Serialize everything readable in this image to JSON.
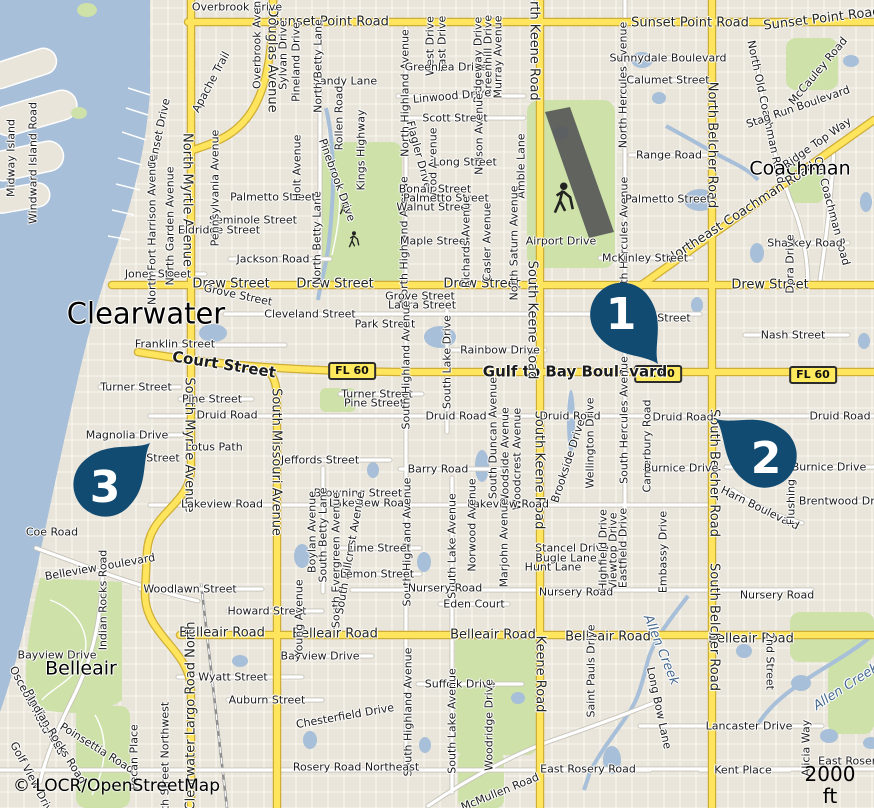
{
  "map": {
    "attribution": "© LOCR/OpenStreetMap",
    "scale_label": "2000 ft",
    "colors": {
      "marker": "#114b72",
      "marker_text": "#ffffff",
      "water": "#a7bfd8",
      "land": "#e9e5db",
      "park": "#cde1a9",
      "road_major": "#ffe55e",
      "road_major_casing": "#cfae35",
      "road_minor": "#ffffff",
      "badge_bg": "#ffe95c"
    },
    "markers": [
      {
        "n": "1",
        "tx": 658,
        "ty": 364,
        "rot": -36,
        "nx": 621,
        "ny": 313
      },
      {
        "n": "2",
        "tx": 716,
        "ty": 419,
        "rot": 127,
        "nx": 766,
        "ny": 457
      },
      {
        "n": "3",
        "tx": 150,
        "ty": 443,
        "rot": -133,
        "nx": 105,
        "ny": 486
      }
    ],
    "badges": [
      {
        "t": "FL 60",
        "x": 352,
        "y": 371
      },
      {
        "t": "FL 60",
        "x": 658,
        "y": 374
      },
      {
        "t": "FL 60",
        "x": 813,
        "y": 375
      }
    ],
    "labels": [
      {
        "t": "Sunset Point Road",
        "x": 330,
        "y": 22,
        "c": "h"
      },
      {
        "t": "Sunset Point Road",
        "x": 690,
        "y": 23,
        "c": "h"
      },
      {
        "t": "Sunset Point Road",
        "x": 822,
        "y": 19,
        "r": -7,
        "c": "h"
      },
      {
        "t": "Drew Street",
        "x": 231,
        "y": 284,
        "c": "h"
      },
      {
        "t": "Drew Street",
        "x": 335,
        "y": 284,
        "c": "h"
      },
      {
        "t": "Drew Street",
        "x": 482,
        "y": 284,
        "c": "h"
      },
      {
        "t": "Drew Street",
        "x": 770,
        "y": 285,
        "c": "h"
      },
      {
        "t": "Gulf to Bay Boulevard",
        "x": 575,
        "y": 372,
        "s": 15,
        "b": 1
      },
      {
        "t": "Court Street",
        "x": 224,
        "y": 365,
        "r": 9,
        "s": 15,
        "b": 1
      },
      {
        "t": "Belleair Road",
        "x": 222,
        "y": 633,
        "c": "h"
      },
      {
        "t": "Belleair Road",
        "x": 335,
        "y": 634,
        "c": "h"
      },
      {
        "t": "Belleair Road",
        "x": 493,
        "y": 635,
        "c": "h"
      },
      {
        "t": "Belleair Road",
        "x": 608,
        "y": 637,
        "c": "h"
      },
      {
        "t": "Belleair Road",
        "x": 751,
        "y": 639,
        "c": "h"
      },
      {
        "t": "Northeast Coachman Road",
        "x": 741,
        "y": 213,
        "r": -33,
        "c": "h"
      },
      {
        "t": "North Myrtle Avenue",
        "x": 187,
        "y": 200,
        "r": 90,
        "c": "h"
      },
      {
        "t": "South Myrtle Avenue",
        "x": 189,
        "y": 445,
        "r": 90,
        "c": "h"
      },
      {
        "t": "South Missouri Avenue",
        "x": 276,
        "y": 462,
        "r": 90,
        "c": "h"
      },
      {
        "t": "North Keene Road",
        "x": 534,
        "y": 42,
        "r": 90,
        "c": "h"
      },
      {
        "t": "South Keene Road",
        "x": 532,
        "y": 320,
        "r": 90,
        "c": "h"
      },
      {
        "t": "South Keene Road",
        "x": 539,
        "y": 470,
        "r": 90,
        "c": "h"
      },
      {
        "t": "Keene Road",
        "x": 540,
        "y": 674,
        "r": 90,
        "c": "h"
      },
      {
        "t": "North Belcher Road",
        "x": 712,
        "y": 145,
        "r": 90,
        "c": "h"
      },
      {
        "t": "South Belcher Road",
        "x": 714,
        "y": 473,
        "r": 90,
        "c": "h"
      },
      {
        "t": "South Belcher Road",
        "x": 714,
        "y": 627,
        "r": 90,
        "c": "h"
      },
      {
        "t": "Douglas Avenue",
        "x": 272,
        "y": 60,
        "r": 90,
        "c": "h"
      },
      {
        "t": "Clearwater Largo Road North",
        "x": 191,
        "y": 716,
        "r": -90,
        "c": "h"
      },
      {
        "t": "Old Coachman Road",
        "x": 832,
        "y": 211,
        "r": 75
      },
      {
        "t": "North Old Coachman Road",
        "x": 766,
        "y": 112,
        "r": 78
      },
      {
        "t": "Clearwater",
        "x": 146,
        "y": 314,
        "s": 29,
        "c": "city"
      },
      {
        "t": "Belleair",
        "x": 81,
        "y": 669,
        "s": 19,
        "c": "city"
      },
      {
        "t": "Coachman",
        "x": 800,
        "y": 169,
        "s": 19,
        "c": "city"
      },
      {
        "t": "Allen Creek",
        "x": 661,
        "y": 650,
        "r": 68,
        "s": 13,
        "c": "water"
      },
      {
        "t": "Allen Creek",
        "x": 846,
        "y": 687,
        "r": -33,
        "s": 13,
        "c": "water"
      },
      {
        "t": "Overbrook Drive",
        "x": 237,
        "y": 7
      },
      {
        "t": "Overbrook Avenue",
        "x": 257,
        "y": 38,
        "r": -90
      },
      {
        "t": "Sylvan Drive",
        "x": 283,
        "y": 55,
        "r": -90
      },
      {
        "t": "Pineland Drive",
        "x": 296,
        "y": 62,
        "r": -90
      },
      {
        "t": "Midway Island",
        "x": 11,
        "y": 158,
        "r": -90
      },
      {
        "t": "Windward Island Road",
        "x": 33,
        "y": 163,
        "r": -90
      },
      {
        "t": "Sunset Drive",
        "x": 159,
        "y": 133,
        "r": -78
      },
      {
        "t": "Apache Trail",
        "x": 211,
        "y": 82,
        "r": -62
      },
      {
        "t": "Sandy Lane",
        "x": 345,
        "y": 81
      },
      {
        "t": "Rollen Road",
        "x": 339,
        "y": 118,
        "r": -90
      },
      {
        "t": "Kings Highway",
        "x": 361,
        "y": 150,
        "r": -90
      },
      {
        "t": "North Betty Lane",
        "x": 318,
        "y": 66,
        "r": -90
      },
      {
        "t": "North Betty Lane",
        "x": 317,
        "y": 238,
        "r": -90
      },
      {
        "t": "North Highland Avenue",
        "x": 405,
        "y": 93,
        "r": -90
      },
      {
        "t": "North Highland Avenue",
        "x": 404,
        "y": 240,
        "r": -90
      },
      {
        "t": "West Drive",
        "x": 430,
        "y": 46,
        "r": -90
      },
      {
        "t": "East Drive",
        "x": 442,
        "y": 44,
        "r": -90
      },
      {
        "t": "Greenlea Drive",
        "x": 446,
        "y": 67
      },
      {
        "t": "Ridgeway Drive",
        "x": 478,
        "y": 60,
        "r": -90
      },
      {
        "t": "Greenhill Drive",
        "x": 488,
        "y": 56,
        "r": -90
      },
      {
        "t": "Murray Avenue",
        "x": 498,
        "y": 57,
        "r": -90
      },
      {
        "t": "Linwood Drive",
        "x": 452,
        "y": 96,
        "r": -5
      },
      {
        "t": "Scott Street",
        "x": 455,
        "y": 118
      },
      {
        "t": "Flagler Drive",
        "x": 419,
        "y": 155,
        "r": 75
      },
      {
        "t": "Wood Avenue",
        "x": 433,
        "y": 165,
        "r": -90
      },
      {
        "t": "Nelson Avenue",
        "x": 479,
        "y": 134,
        "r": -90
      },
      {
        "t": "Long Street",
        "x": 465,
        "y": 162
      },
      {
        "t": "Amble Lane",
        "x": 521,
        "y": 166,
        "r": -90
      },
      {
        "t": "Bonair Street",
        "x": 435,
        "y": 189
      },
      {
        "t": "Palmetto Street",
        "x": 446,
        "y": 198
      },
      {
        "t": "Walnut Street",
        "x": 434,
        "y": 207
      },
      {
        "t": "Maple Street",
        "x": 435,
        "y": 241
      },
      {
        "t": "Richards Avenue",
        "x": 466,
        "y": 242,
        "r": -90
      },
      {
        "t": "Casler Avenue",
        "x": 487,
        "y": 242,
        "r": -90
      },
      {
        "t": "North Saturn Avenue",
        "x": 514,
        "y": 243,
        "r": -90
      },
      {
        "t": "Airport Drive",
        "x": 561,
        "y": 241
      },
      {
        "t": "Palmetto Street",
        "x": 273,
        "y": 197
      },
      {
        "t": "Seminole Street",
        "x": 253,
        "y": 220
      },
      {
        "t": "Eldridge Street",
        "x": 219,
        "y": 230
      },
      {
        "t": "Holt Avenue",
        "x": 297,
        "y": 168,
        "r": -90
      },
      {
        "t": "Pinebrook Drive",
        "x": 337,
        "y": 180,
        "r": 70
      },
      {
        "t": "Jackson Road",
        "x": 273,
        "y": 259
      },
      {
        "t": "Jones Street",
        "x": 158,
        "y": 274
      },
      {
        "t": "North Fort Harrison Avenue",
        "x": 152,
        "y": 230,
        "r": -90
      },
      {
        "t": "North Garden Avenue",
        "x": 170,
        "y": 226,
        "r": -90
      },
      {
        "t": "Pennsylvania Avenue",
        "x": 215,
        "y": 188,
        "r": -90
      },
      {
        "t": "Grove Street",
        "x": 238,
        "y": 295,
        "r": 12
      },
      {
        "t": "Cleveland Street",
        "x": 310,
        "y": 314
      },
      {
        "t": "Cleveland Street",
        "x": 645,
        "y": 318
      },
      {
        "t": "Franklin Street",
        "x": 175,
        "y": 344
      },
      {
        "t": "Park Street",
        "x": 385,
        "y": 324
      },
      {
        "t": "Grove Street",
        "x": 420,
        "y": 296
      },
      {
        "t": "Laura Street",
        "x": 422,
        "y": 305
      },
      {
        "t": "Rainbow Drive",
        "x": 500,
        "y": 350
      },
      {
        "t": "Nash Street",
        "x": 793,
        "y": 335
      },
      {
        "t": "Turner Street",
        "x": 136,
        "y": 387
      },
      {
        "t": "Pine Street",
        "x": 212,
        "y": 399
      },
      {
        "t": "Turner Street",
        "x": 377,
        "y": 394
      },
      {
        "t": "Pine Street",
        "x": 374,
        "y": 403
      },
      {
        "t": "Druid Road",
        "x": 227,
        "y": 415
      },
      {
        "t": "Druid Road",
        "x": 456,
        "y": 416
      },
      {
        "t": "Druid Road",
        "x": 570,
        "y": 416
      },
      {
        "t": "Druid Road",
        "x": 683,
        "y": 417
      },
      {
        "t": "Druid Road",
        "x": 840,
        "y": 416
      },
      {
        "t": "Magnolia Drive",
        "x": 127,
        "y": 435
      },
      {
        "t": "Street",
        "x": 163,
        "y": 458
      },
      {
        "t": "Lotus Path",
        "x": 214,
        "y": 447
      },
      {
        "t": "South Highland Avenue",
        "x": 406,
        "y": 365,
        "r": -90
      },
      {
        "t": "South Lake Drive",
        "x": 447,
        "y": 362,
        "r": -90
      },
      {
        "t": "South Duncan Avenue",
        "x": 493,
        "y": 438,
        "r": -90
      },
      {
        "t": "Woodside Avenue",
        "x": 505,
        "y": 456,
        "r": -90
      },
      {
        "t": "Woodcrest Avenue",
        "x": 517,
        "y": 459,
        "r": -90
      },
      {
        "t": "North Hercules Avenue",
        "x": 623,
        "y": 85,
        "r": -90
      },
      {
        "t": "North Hercules Avenue",
        "x": 624,
        "y": 240,
        "r": -90
      },
      {
        "t": "South Hercules Avenue",
        "x": 624,
        "y": 420,
        "r": -90
      },
      {
        "t": "Wellington Drive",
        "x": 590,
        "y": 443,
        "r": -90
      },
      {
        "t": "Canterbury Road",
        "x": 647,
        "y": 446,
        "r": -90
      },
      {
        "t": "Burnice Drive",
        "x": 681,
        "y": 468
      },
      {
        "t": "Burnice Drive",
        "x": 829,
        "y": 467
      },
      {
        "t": "Harn Boulevard",
        "x": 760,
        "y": 508,
        "r": 26
      },
      {
        "t": "Flushing",
        "x": 791,
        "y": 502,
        "r": -90
      },
      {
        "t": "Brentwood Drive",
        "x": 845,
        "y": 501
      },
      {
        "t": "Brookside Drive",
        "x": 568,
        "y": 461,
        "r": -72
      },
      {
        "t": "Jeffords Street",
        "x": 320,
        "y": 460
      },
      {
        "t": "Barry Road",
        "x": 438,
        "y": 469
      },
      {
        "t": "Browning Street",
        "x": 358,
        "y": 493
      },
      {
        "t": "Lakeview Road",
        "x": 222,
        "y": 504
      },
      {
        "t": "Lakeview Road",
        "x": 370,
        "y": 503
      },
      {
        "t": "Lakeview Road",
        "x": 508,
        "y": 504
      },
      {
        "t": "Coe Road",
        "x": 52,
        "y": 532
      },
      {
        "t": "Boylan Avenue",
        "x": 312,
        "y": 532,
        "r": -90
      },
      {
        "t": "South Betty Lane",
        "x": 323,
        "y": 535,
        "r": -90
      },
      {
        "t": "South Evergreen Avenue",
        "x": 336,
        "y": 560,
        "r": -90
      },
      {
        "t": "South Hillcrest Avenue",
        "x": 350,
        "y": 553,
        "r": -80
      },
      {
        "t": "South Highland Avenue",
        "x": 407,
        "y": 542,
        "r": -90
      },
      {
        "t": "Lime Street",
        "x": 379,
        "y": 548
      },
      {
        "t": "Lemon Street",
        "x": 377,
        "y": 574
      },
      {
        "t": "South Lake Avenue",
        "x": 452,
        "y": 546,
        "r": -90
      },
      {
        "t": "Norwood Avenue",
        "x": 472,
        "y": 525,
        "r": -90
      },
      {
        "t": "Marjohn Avenue",
        "x": 504,
        "y": 543,
        "r": -90
      },
      {
        "t": "Stancel Drive",
        "x": 572,
        "y": 548
      },
      {
        "t": "Bugle Lane",
        "x": 566,
        "y": 558
      },
      {
        "t": "Hunt Lane",
        "x": 553,
        "y": 567
      },
      {
        "t": "Highfield Drive",
        "x": 603,
        "y": 550,
        "r": -90
      },
      {
        "t": "Viewtop Drive",
        "x": 613,
        "y": 551,
        "r": -90
      },
      {
        "t": "Eastfield Drive",
        "x": 623,
        "y": 548,
        "r": -90
      },
      {
        "t": "Embassy Drive",
        "x": 663,
        "y": 552,
        "r": -90
      },
      {
        "t": "McKinley Street",
        "x": 645,
        "y": 258
      },
      {
        "t": "Range Road",
        "x": 669,
        "y": 155
      },
      {
        "t": "Palmetto Street",
        "x": 668,
        "y": 199
      },
      {
        "t": "Sunnydale Boulevard",
        "x": 668,
        "y": 58
      },
      {
        "t": "Calumet Street",
        "x": 668,
        "y": 80
      },
      {
        "t": "Sharkey Road",
        "x": 805,
        "y": 243
      },
      {
        "t": "Dora Drive",
        "x": 790,
        "y": 264,
        "r": -90
      },
      {
        "t": "McCauley Road",
        "x": 818,
        "y": 71,
        "r": -50
      },
      {
        "t": "Stag Run Boulevard",
        "x": 798,
        "y": 107,
        "r": -19
      },
      {
        "t": "Ridge Top Way",
        "x": 817,
        "y": 143,
        "r": -35
      },
      {
        "t": "Nursery Road",
        "x": 445,
        "y": 588
      },
      {
        "t": "Nursery Road",
        "x": 576,
        "y": 592
      },
      {
        "t": "Nursery Road",
        "x": 777,
        "y": 595
      },
      {
        "t": "Eden Court",
        "x": 474,
        "y": 604
      },
      {
        "t": "Woodlawn Street",
        "x": 190,
        "y": 589
      },
      {
        "t": "Howard Street",
        "x": 267,
        "y": 611
      },
      {
        "t": "Bayview Drive",
        "x": 57,
        "y": 655
      },
      {
        "t": "Bayview Drive",
        "x": 320,
        "y": 656
      },
      {
        "t": "Wyatt Street",
        "x": 233,
        "y": 677
      },
      {
        "t": "Auburn Street",
        "x": 267,
        "y": 700
      },
      {
        "t": "Belleview Boulevard",
        "x": 100,
        "y": 567,
        "r": -10
      },
      {
        "t": "Indian Rocks Road",
        "x": 103,
        "y": 600,
        "r": -90
      },
      {
        "t": "Osceola Road",
        "x": 30,
        "y": 700,
        "r": 62
      },
      {
        "t": "Pinellas Road",
        "x": 45,
        "y": 722,
        "r": 62
      },
      {
        "t": "Indian Rocks Road",
        "x": 57,
        "y": 740,
        "r": 58
      },
      {
        "t": "Golf View Drive",
        "x": 33,
        "y": 780,
        "r": 62
      },
      {
        "t": "Poinsettia Road",
        "x": 97,
        "y": 748,
        "r": 32
      },
      {
        "t": "Pecan Place",
        "x": 134,
        "y": 757,
        "r": -90
      },
      {
        "t": "10th Street Northwest",
        "x": 165,
        "y": 763,
        "r": -90
      },
      {
        "t": "Young Avenue",
        "x": 299,
        "y": 618,
        "r": -90
      },
      {
        "t": "Chesterfield Drive",
        "x": 345,
        "y": 716,
        "r": -10
      },
      {
        "t": "Suffolk Drive",
        "x": 460,
        "y": 684
      },
      {
        "t": "South Highland Avenue",
        "x": 408,
        "y": 712,
        "r": -90
      },
      {
        "t": "South Lake Avenue",
        "x": 452,
        "y": 721,
        "r": -90
      },
      {
        "t": "Woodridge Drive",
        "x": 489,
        "y": 725,
        "r": -90
      },
      {
        "t": "Rosery Road Northeast",
        "x": 356,
        "y": 767
      },
      {
        "t": "East Rosery Road",
        "x": 588,
        "y": 769
      },
      {
        "t": "East Rosery Road",
        "x": 866,
        "y": 761
      },
      {
        "t": "Kent Place",
        "x": 743,
        "y": 770
      },
      {
        "t": "Lancaster Drive",
        "x": 749,
        "y": 726
      },
      {
        "t": "Alicia Way",
        "x": 806,
        "y": 748,
        "r": -90
      },
      {
        "t": "2nd Street",
        "x": 770,
        "y": 661,
        "r": 90
      },
      {
        "t": "Saint Pauls Drive",
        "x": 591,
        "y": 671,
        "r": -90
      },
      {
        "t": "Long Bow Lane",
        "x": 659,
        "y": 708,
        "r": 78
      },
      {
        "t": "McMullen Road",
        "x": 500,
        "y": 792,
        "r": -22
      }
    ]
  }
}
